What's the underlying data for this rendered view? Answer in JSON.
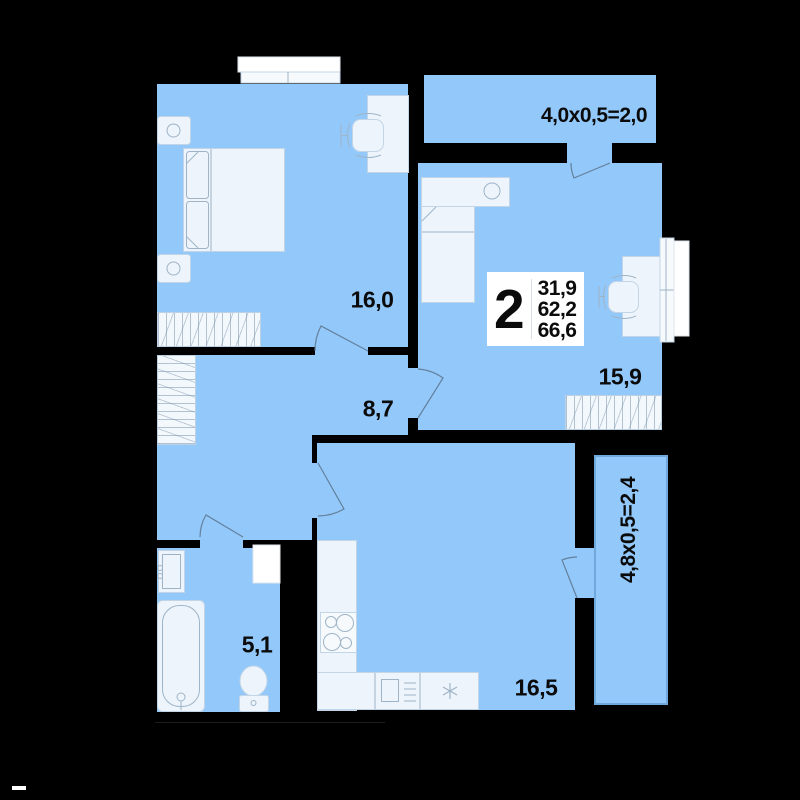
{
  "plan_info": {
    "rooms_count": "2",
    "living_area": "31,9",
    "area_without_balcony": "62,2",
    "total_area": "66,6"
  },
  "rooms": {
    "bedroom": {
      "area": "16,0"
    },
    "bedroom2": {
      "area": "15,9"
    },
    "hall": {
      "area": "8,7"
    },
    "bathroom": {
      "area": "5,1"
    },
    "kitchen": {
      "area": "16,5"
    }
  },
  "balconies": {
    "top": {
      "label": "4,0x0,5=2,0"
    },
    "right": {
      "label": "4,8x0,5=2,4"
    }
  },
  "icons": [
    "double-bed-icon",
    "single-bed-icon",
    "nightstand-icon",
    "wardrobe-icon",
    "desk-icon",
    "office-chair-icon",
    "window-icon",
    "bathtub-icon",
    "toilet-icon",
    "washbasin-icon",
    "stove-icon",
    "kitchen-counter-icon",
    "kitchen-sink-icon",
    "dishwasher-icon",
    "door-swing-icon"
  ],
  "colors": {
    "background_wall": "#000000",
    "room_fill": "#93c8fb",
    "balcony_border": "#6fa9dc",
    "furniture_fill": "#edf4fc",
    "furniture_stroke": "#c2d5e6",
    "label_text": "#0b0b0b",
    "info_box_bg": "#ffffff"
  }
}
